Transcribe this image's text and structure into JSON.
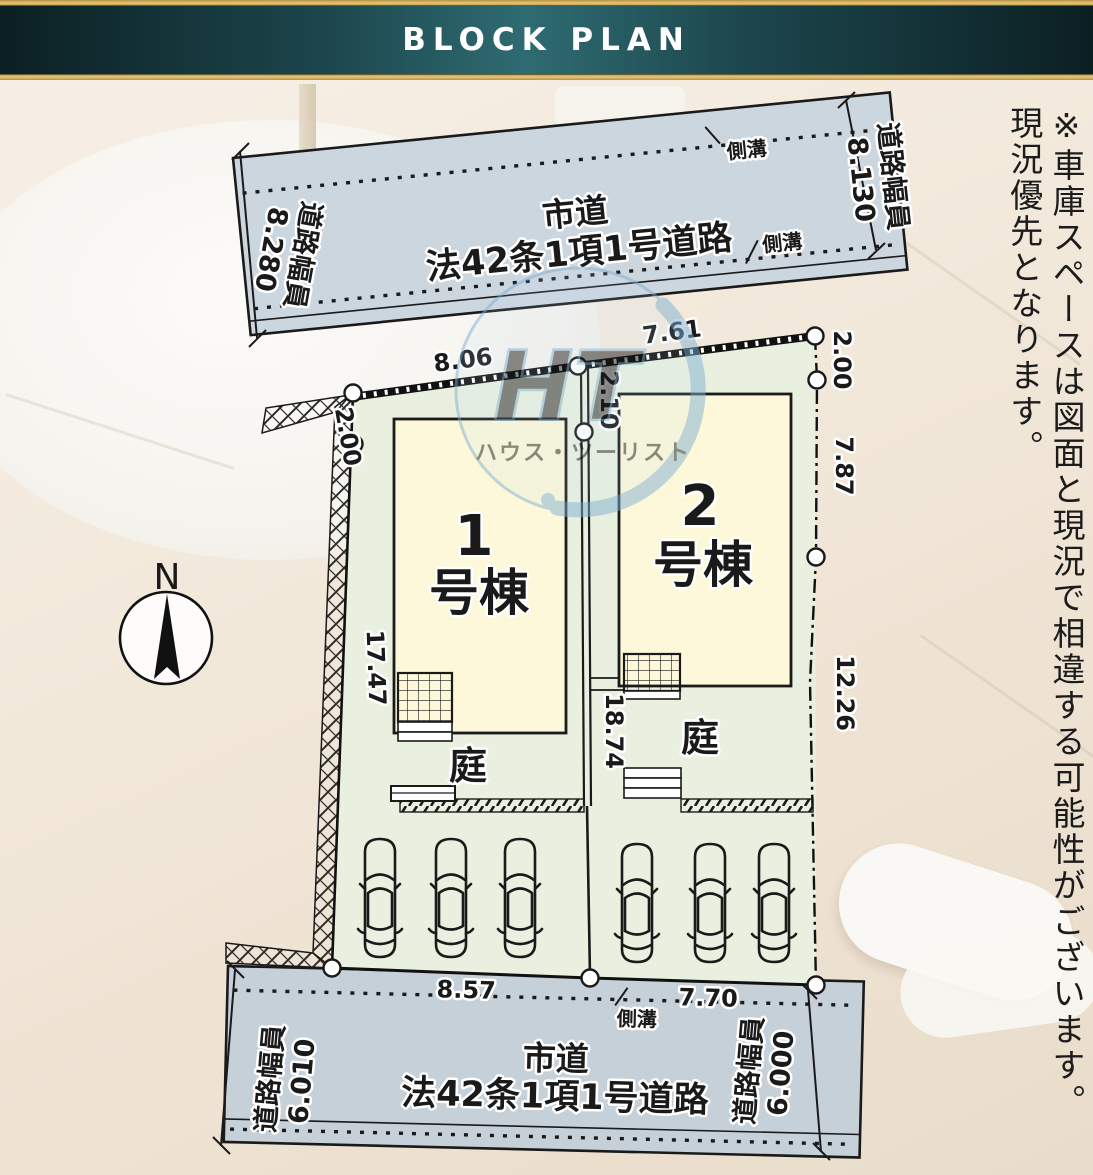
{
  "header": {
    "title": "BLOCK PLAN"
  },
  "side_note": {
    "column1": "※車庫スペースは図面と現況で相違する可能性がございます。",
    "column2": "現況優先となります。"
  },
  "compass": {
    "north_label": "N"
  },
  "watermark": {
    "letters": "HT",
    "name": "ハウス・ツーリスト"
  },
  "roads": {
    "top": {
      "type_label": "市道",
      "law_label": "法42条1項1号道路",
      "gutter": "側溝",
      "width_left_label": "道路幅員",
      "width_left_value": "8.280",
      "width_right_label": "道路幅員",
      "width_right_value": "8.130"
    },
    "bottom": {
      "type_label": "市道",
      "law_label": "法42条1項1号道路",
      "gutter": "側溝",
      "width_left_label": "道路幅員",
      "width_left_value": "6.010",
      "width_right_label": "道路幅員",
      "width_right_value": "6.000"
    }
  },
  "site": {
    "dims": {
      "top_left": "8.06",
      "top_right": "7.61",
      "left_upper": "2.00",
      "left_side": "17.47",
      "center_upper": "2.10",
      "center_side": "18.74",
      "right_upper": "2.00",
      "right_mid": "7.87",
      "right_lower": "12.26",
      "bottom_left": "8.57",
      "bottom_right": "7.70",
      "gutter": "側溝"
    },
    "lots": [
      {
        "number": "1",
        "suffix": "号棟",
        "garden": "庭"
      },
      {
        "number": "2",
        "suffix": "号棟",
        "garden": "庭"
      }
    ]
  },
  "colors": {
    "lot_fill": "#e9f0e0",
    "building_fill": "#fcf8d9",
    "road_fill": "#ccd6df",
    "header_teal": "#2f6b72",
    "gold": "#c9a44c",
    "watermark_blue": "#7fb0d2"
  }
}
